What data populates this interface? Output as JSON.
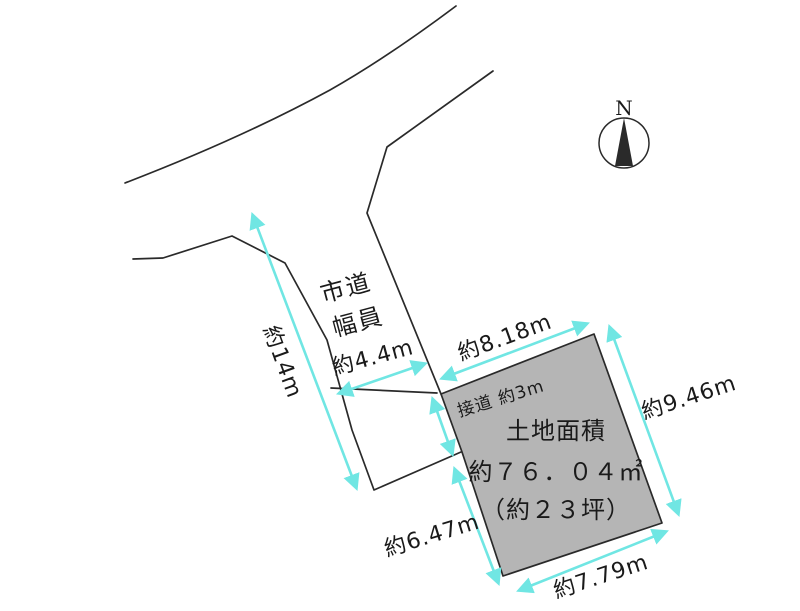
{
  "colors": {
    "line": "#2a2a2a",
    "dim": "#70e6e3",
    "parcel_fill": "#b5b5b5",
    "text": "#1a1a1a",
    "bg": "#ffffff"
  },
  "north": {
    "label": "N"
  },
  "road": {
    "name": "市道",
    "width_caption": "幅員",
    "width_value": "約4.4m"
  },
  "parcel": {
    "title": "土地面積",
    "area_sqm": "約７６．０４㎡",
    "area_tsubo": "（約２３坪）"
  },
  "dimensions": {
    "road_length": "約14m",
    "frontage": "接道 約3m",
    "north_edge": "約8.18m",
    "east_edge": "約9.46m",
    "west_edge": "約6.47m",
    "south_edge": "約7.79m"
  }
}
